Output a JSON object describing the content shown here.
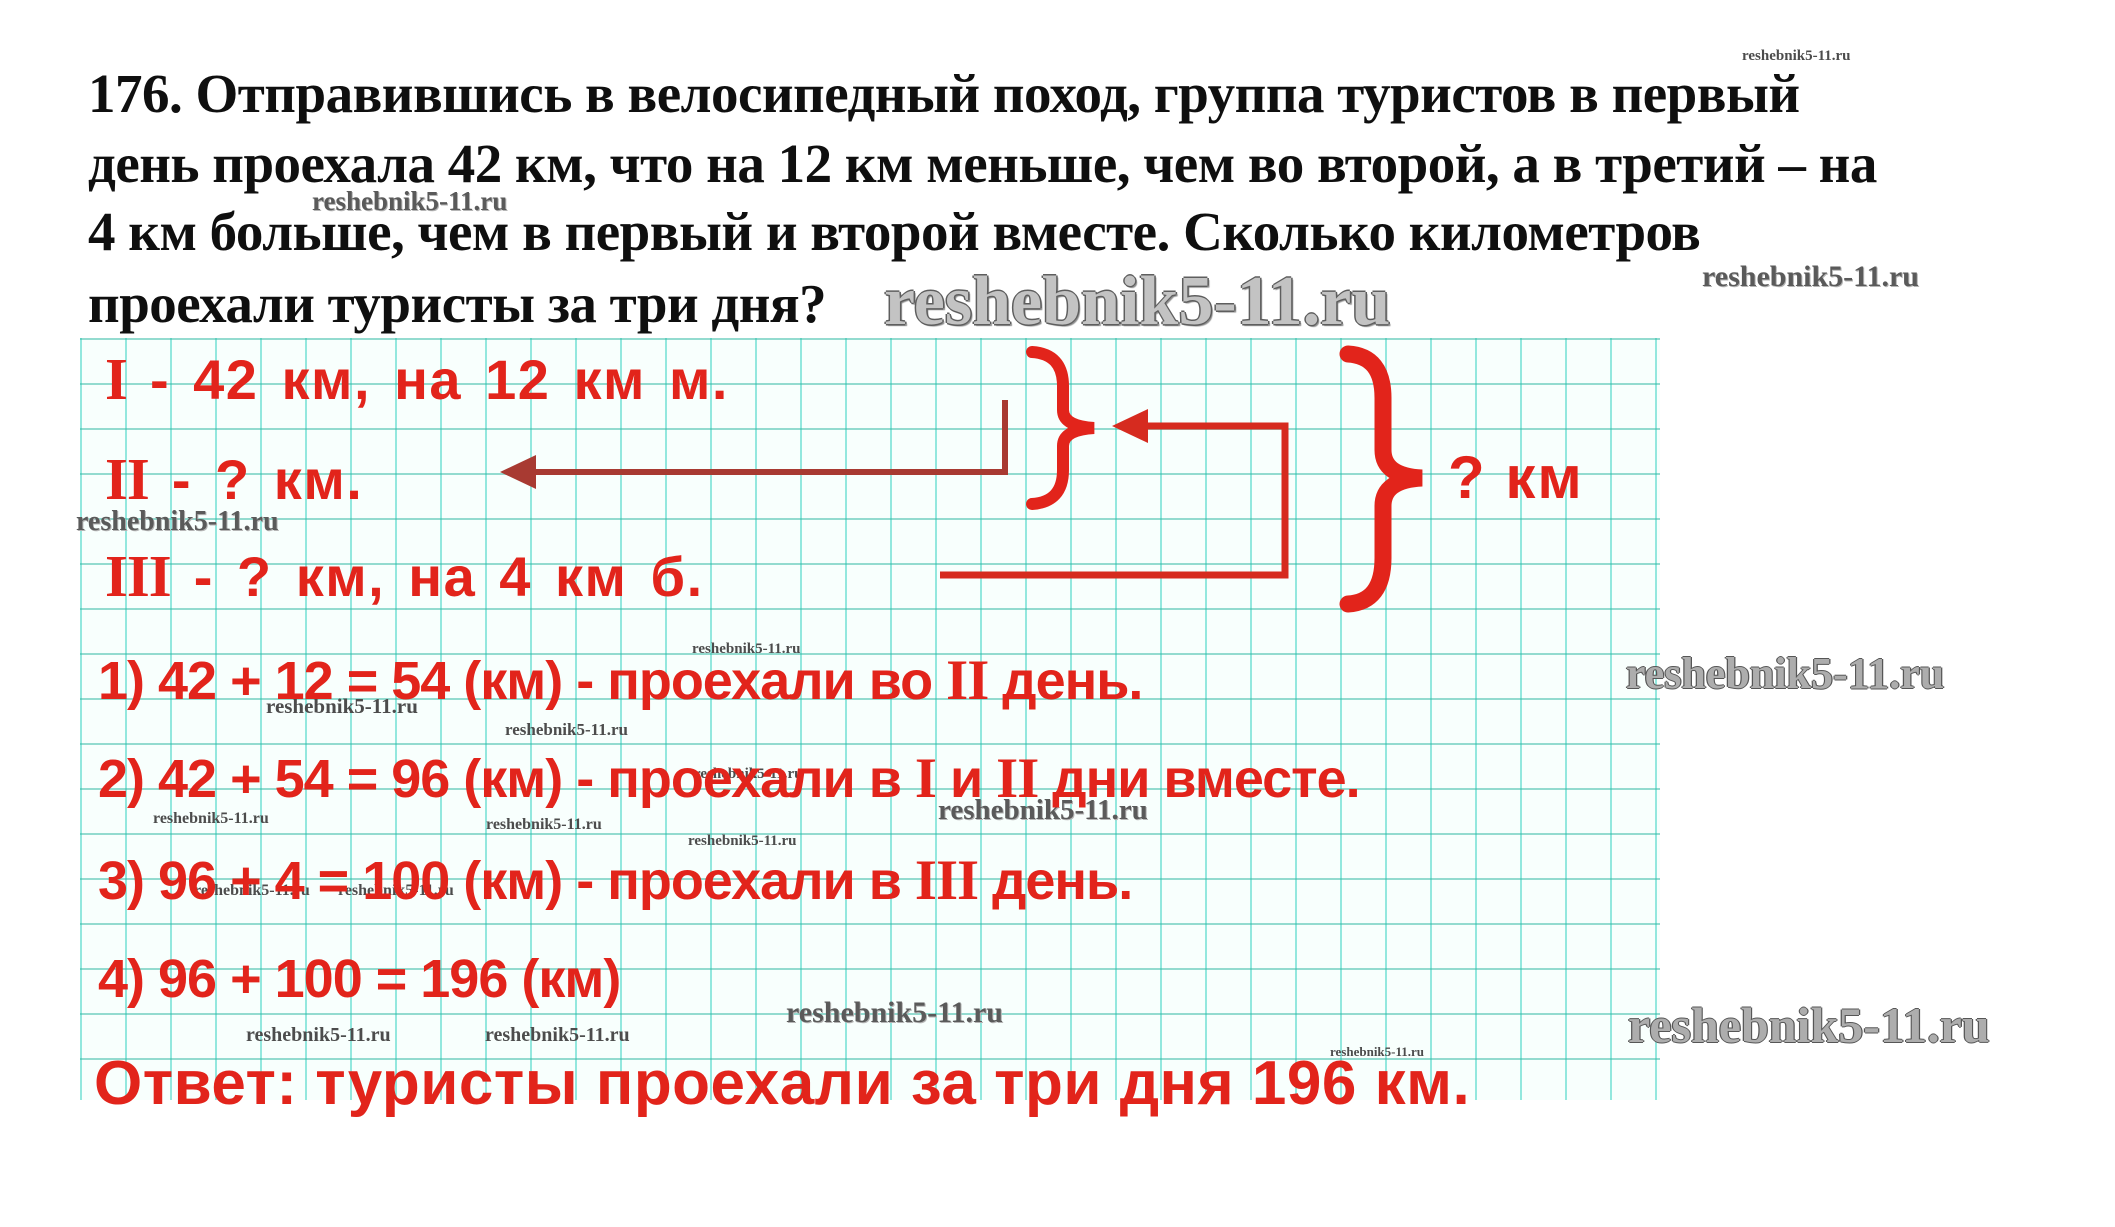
{
  "problem": {
    "lines": [
      "176. Отправившись в велосипедный поход, группа туристов в первый",
      "день проехала 42 км, что на 12 км меньше, чем во второй, а в третий – на",
      "4 км больше, чем в первый и второй вместе. Сколько километров",
      "проехали туристы за три дня?"
    ]
  },
  "diagram": {
    "rows": [
      {
        "numeral": "I",
        "text": " - 42 км, на 12 км м."
      },
      {
        "numeral": "II",
        "text": " - ? км."
      },
      {
        "numeral": "III",
        "text": " - ? км, на 4 км б."
      }
    ],
    "total_label": "? км"
  },
  "solution": {
    "steps": [
      {
        "segments": [
          "1) 42 + 12 = 54 (км) - проехали во ",
          "II",
          " день."
        ]
      },
      {
        "segments": [
          "2) 42 + 54 = 96 (км) - проехали в ",
          "I",
          " и ",
          "II",
          " дни вместе."
        ]
      },
      {
        "segments": [
          "3) 96 + 4 = 100 (км) - проехали в ",
          "III",
          " день."
        ]
      },
      {
        "segments": [
          "4) 96 + 100 = 196 (км)"
        ]
      }
    ],
    "answer": "Ответ: туристы проехали за три дня 196 км."
  },
  "watermark": {
    "text": "reshebnik5-11.ru"
  },
  "colors": {
    "red": "#e2241b",
    "arrow_dark_red": "#a83a32",
    "black_text": "#0f0f0f",
    "grid_vertical": "#40d4c4",
    "grid_horizontal": "#2fb7a2",
    "grid_background": "#f8fffd",
    "watermark_gray": "#c3c3c3",
    "watermark_dark": "#4c4c4c"
  }
}
